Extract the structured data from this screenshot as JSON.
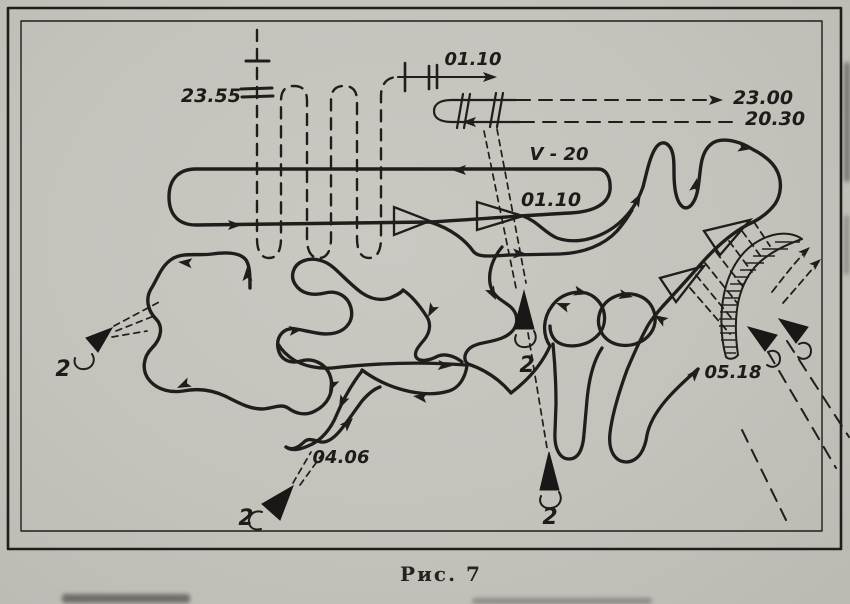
{
  "figure": {
    "caption": "Рис. 7",
    "paper_color": "#c7c4be",
    "ink_color": "#1f1e1c"
  },
  "annotations": {
    "time_2355": "23.55",
    "time_0110_gate": "01.10",
    "time_2300": "23.00",
    "time_2030": "20.30",
    "speed_v20": "V - 20",
    "time_0110_loop": "01.10",
    "time_0406": "04.06",
    "time_0518": "05.18"
  },
  "unit_labels": {
    "sub_west": "2",
    "sub_center": "2",
    "sub_south": "2",
    "sub_southwest": "2"
  }
}
